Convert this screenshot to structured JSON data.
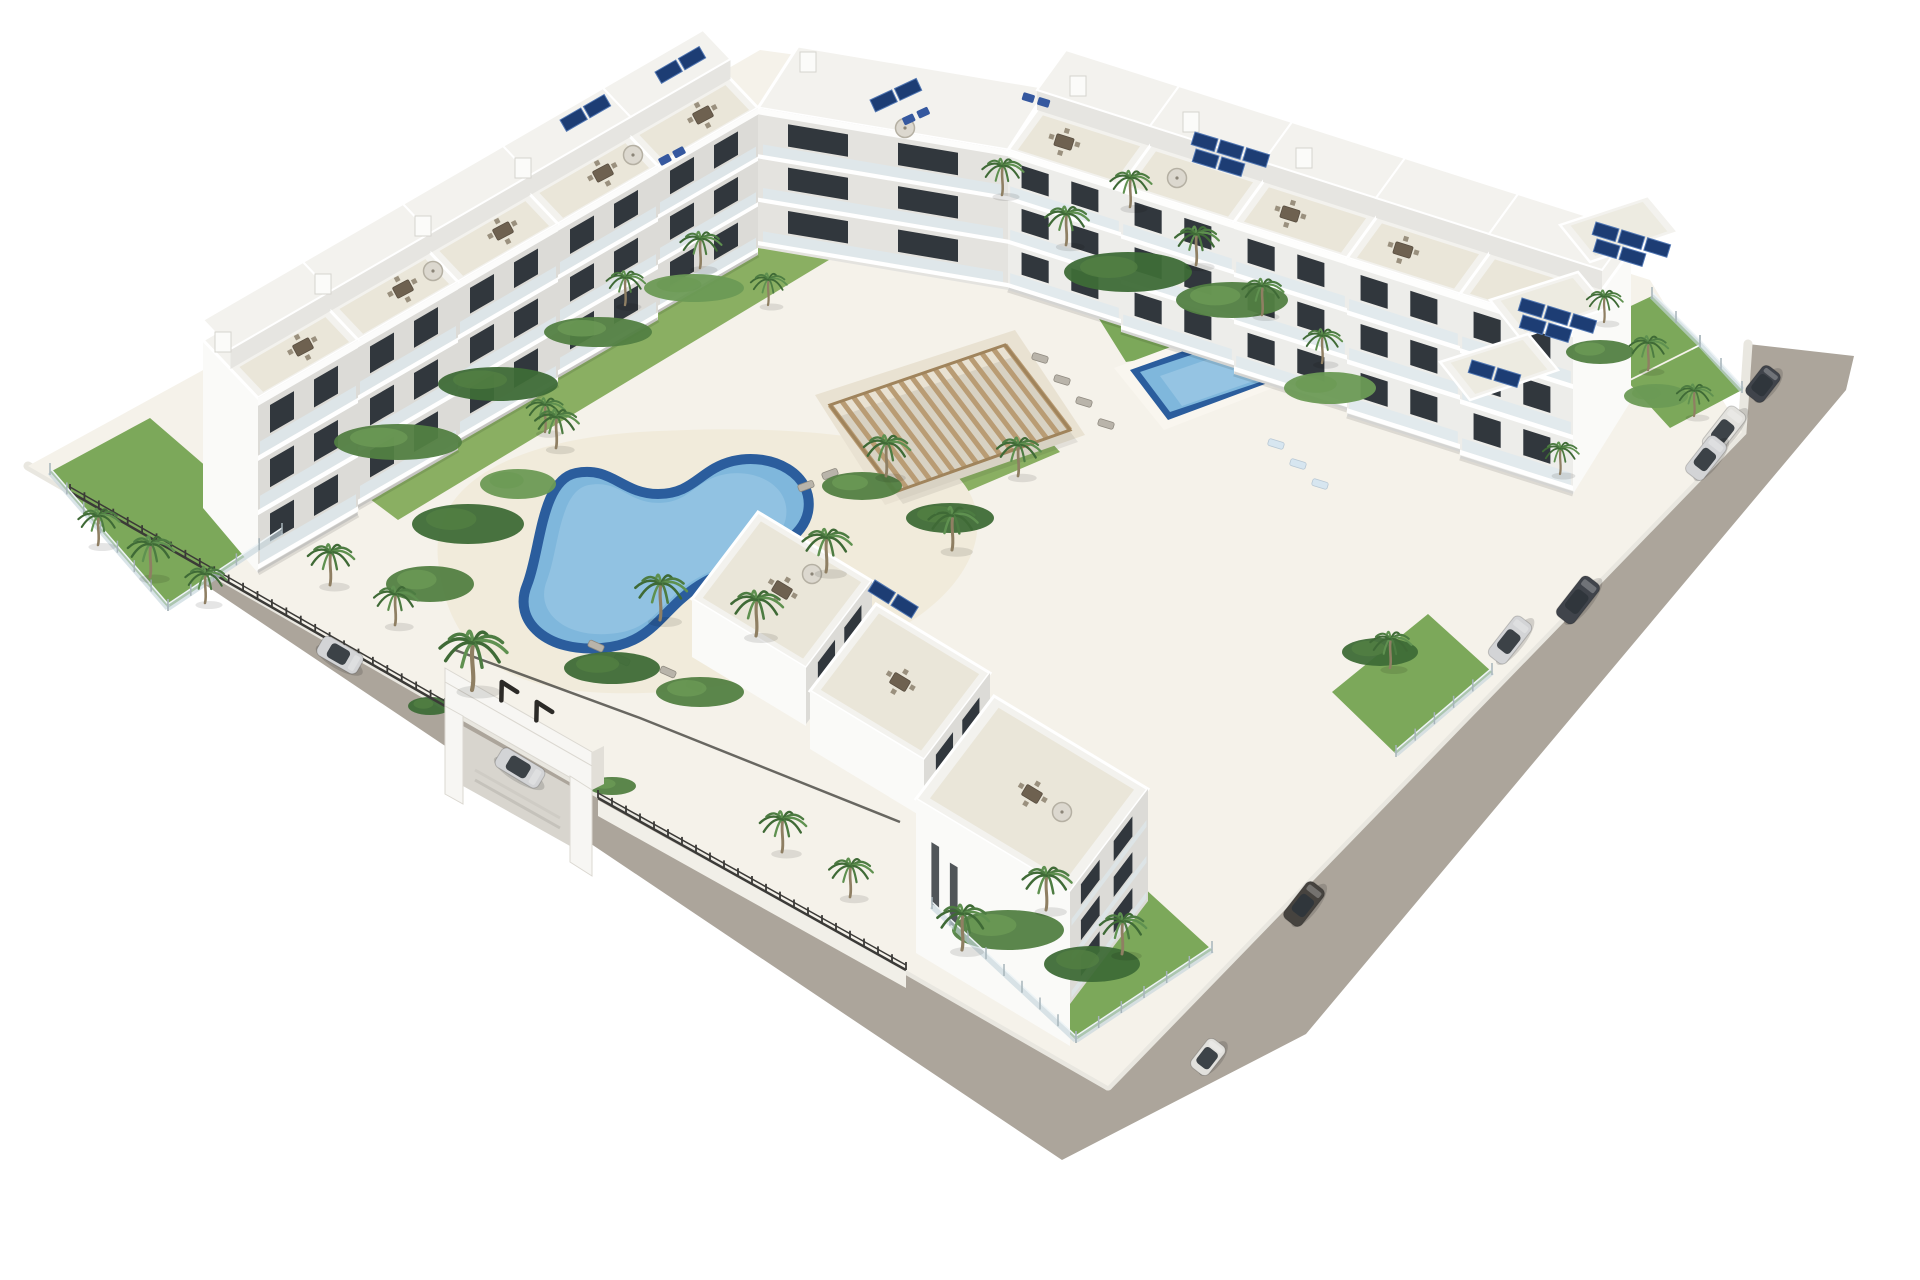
{
  "meta": {
    "type": "architectural_3d_render",
    "subject": "Aerial 3D render of a white modern apartment complex with central kidney-shaped pool, second rectangular pool, wooden pergola, palm trees, roof terraces with furniture, rooftop solar panels, glass-fenced gardens, entrance gate and perimeter road with parked cars",
    "background": "#ffffff"
  },
  "palette": {
    "background": "#ffffff",
    "road": "#aca59b",
    "curb": "#e9e7e0",
    "site": "#f5f2ea",
    "deck": "#f1ebdb",
    "paving": "#e9e2d2",
    "lawn": "#8aaf62",
    "grass": "#7ca85a",
    "shrubDark": "#3e6b37",
    "shrubMid": "#527f42",
    "shrubLight": "#6b9a55",
    "facadeShade": "#dcdbd7",
    "facadeLight": "#ededea",
    "gable": "#fafaf8",
    "roof": "#f3f2ee",
    "terrace": "#eae6d9",
    "stepFace": "#e6e5e1",
    "window": "#31373d",
    "rail": "#dde8ed",
    "slab": "#ffffff",
    "poolRim": "#2b5d9d",
    "water": "#7fb7dc",
    "waterLight": "#a3cde8",
    "pergolaSlat": "#b99c74",
    "pergolaFrame": "#a0845c",
    "fenceDark": "#3b3a37",
    "glass": "#c6d6dd",
    "glassPost": "#a7b4ba",
    "wall": "#f1efe8",
    "wallShade": "#d9d6ce",
    "solar": "#1d3d74",
    "solarLine": "#5076b2",
    "trunk": "#8f7f63",
    "frondDark": "#3f6a36",
    "frondMid": "#4d7c42",
    "frondLight": "#5f9150",
    "furniture": "#6e6150",
    "furnitureLight": "#9a907e",
    "umbrella": "#dcd8cf",
    "loungerGray": "#b9b4aa",
    "loungerBlue": "#35589f",
    "loungerPale": "#d7e6f0",
    "carSilver": "#d3d4d6",
    "carWhite": "#e2e1dd",
    "carDark": "#46433f",
    "carCharcoal": "#40444b",
    "cabin": "#2f353b",
    "shadow": "rgba(0,0,0,0.14)"
  },
  "buildings": {
    "rows": [
      {
        "id": "nw-row",
        "n": 5,
        "bx": 258,
        "by": 398,
        "sx": 100,
        "sy": -58,
        "h0": 175,
        "dh": -7,
        "dx": -55,
        "dy": -58,
        "facade": "facadeShade",
        "gableAt": "start",
        "order": "reverse"
      },
      {
        "id": "ne-row",
        "n": 5,
        "bx": 1008,
        "by": 150,
        "sx": 113,
        "sy": 36,
        "h0": 140,
        "dh": 6,
        "dx": 58,
        "dy": -80,
        "facade": "facadeLight",
        "gableAt": "end",
        "order": "forward"
      }
    ],
    "connector": {
      "facade": [
        [
          758,
          108
        ],
        [
          1008,
          150
        ],
        [
          1008,
          290
        ],
        [
          758,
          248
        ]
      ],
      "roof": [
        [
          758,
          108
        ],
        [
          1008,
          150
        ],
        [
          1048,
          88
        ],
        [
          798,
          46
        ]
      ]
    },
    "annexRoofs": [
      [
        [
          1560,
          225
        ],
        [
          1648,
          196
        ],
        [
          1678,
          232
        ],
        [
          1590,
          262
        ]
      ],
      [
        [
          1490,
          300
        ],
        [
          1578,
          272
        ],
        [
          1608,
          308
        ],
        [
          1520,
          338
        ]
      ],
      [
        [
          1440,
          362
        ],
        [
          1528,
          334
        ],
        [
          1558,
          370
        ],
        [
          1470,
          400
        ]
      ]
    ],
    "seCluster": [
      {
        "roof": [
          [
            758,
            512
          ],
          [
            872,
            581
          ],
          [
            806,
            668
          ],
          [
            692,
            599
          ]
        ],
        "sw": [
          [
            692,
            599
          ],
          [
            806,
            668
          ],
          [
            806,
            726
          ],
          [
            692,
            657
          ]
        ],
        "se": [
          [
            806,
            668
          ],
          [
            872,
            581
          ],
          [
            872,
            637
          ],
          [
            806,
            724
          ]
        ],
        "tall": false
      },
      {
        "roof": [
          [
            876,
            604
          ],
          [
            990,
            673
          ],
          [
            924,
            760
          ],
          [
            810,
            691
          ]
        ],
        "sw": [
          [
            810,
            691
          ],
          [
            924,
            760
          ],
          [
            924,
            818
          ],
          [
            810,
            749
          ]
        ],
        "se": [
          [
            924,
            760
          ],
          [
            990,
            673
          ],
          [
            990,
            731
          ],
          [
            924,
            818
          ]
        ],
        "tall": false
      },
      {
        "roof": [
          [
            994,
            696
          ],
          [
            1148,
            789
          ],
          [
            1070,
            892
          ],
          [
            916,
            799
          ]
        ],
        "sw": [
          [
            916,
            799
          ],
          [
            1070,
            892
          ],
          [
            1070,
            1046
          ],
          [
            916,
            953
          ]
        ],
        "se": [
          [
            1070,
            892
          ],
          [
            1148,
            789
          ],
          [
            1148,
            901
          ],
          [
            1070,
            1004
          ]
        ],
        "tall": true
      }
    ],
    "bulkheads": [
      [
        215,
        332
      ],
      [
        315,
        274
      ],
      [
        415,
        216
      ],
      [
        515,
        158
      ],
      [
        1070,
        76
      ],
      [
        1183,
        112
      ],
      [
        1296,
        148
      ],
      [
        800,
        52
      ]
    ]
  },
  "solarArrays": [
    [
      560,
      120,
      -30,
      2
    ],
    [
      655,
      72,
      -30,
      2
    ],
    [
      870,
      100,
      -25,
      2
    ],
    [
      1195,
      132,
      17,
      3
    ],
    [
      1596,
      222,
      17,
      3
    ],
    [
      1522,
      298,
      17,
      3
    ],
    [
      1472,
      360,
      17,
      2
    ],
    [
      875,
      580,
      32,
      2
    ]
  ],
  "roofFurniture": {
    "tables": [
      [
        303,
        347,
        -28
      ],
      [
        403,
        289,
        -28
      ],
      [
        503,
        231,
        -28
      ],
      [
        603,
        173,
        -28
      ],
      [
        703,
        115,
        -28
      ],
      [
        1064,
        142,
        17
      ],
      [
        1290,
        214,
        17
      ],
      [
        1403,
        250,
        17
      ],
      [
        782,
        590,
        31
      ],
      [
        900,
        682,
        31
      ],
      [
        1032,
        794,
        31
      ]
    ],
    "umbrellas": [
      [
        433,
        271
      ],
      [
        633,
        155
      ],
      [
        1177,
        178
      ],
      [
        812,
        574
      ],
      [
        1062,
        812
      ],
      [
        905,
        128
      ]
    ],
    "blueLoungers": [
      [
        672,
        156,
        -28
      ],
      [
        916,
        116,
        -25
      ],
      [
        1036,
        100,
        17
      ]
    ]
  },
  "courtyard": {
    "grayLoungers": [
      [
        1040,
        358,
        17
      ],
      [
        1062,
        380,
        17
      ],
      [
        1084,
        402,
        17
      ],
      [
        1106,
        424,
        17
      ],
      [
        596,
        646,
        24
      ],
      [
        622,
        660,
        24
      ],
      [
        668,
        672,
        24
      ],
      [
        694,
        686,
        24
      ],
      [
        806,
        486,
        -20
      ],
      [
        830,
        474,
        -20
      ]
    ],
    "paleLoungers": [
      [
        1276,
        444,
        17
      ],
      [
        1298,
        464,
        17
      ],
      [
        1320,
        484,
        17
      ]
    ]
  },
  "pergola": {
    "corners": [
      [
        830,
        405
      ],
      [
        1005,
        345
      ],
      [
        1070,
        430
      ],
      [
        895,
        492
      ]
    ],
    "slats": 16
  },
  "gardens": [
    {
      "pts": [
        [
          50,
          472
        ],
        [
          150,
          418
        ],
        [
          282,
          532
        ],
        [
          168,
          608
        ]
      ],
      "tone": "grass"
    },
    {
      "pts": [
        [
          342,
          478
        ],
        [
          862,
          168
        ],
        [
          920,
          205
        ],
        [
          398,
          520
        ]
      ],
      "tone": "lawn"
    },
    {
      "pts": [
        [
          1076,
          282
        ],
        [
          1272,
          248
        ],
        [
          1320,
          330
        ],
        [
          1126,
          362
        ]
      ],
      "tone": "grass"
    },
    {
      "pts": [
        [
          932,
          906
        ],
        [
          1072,
          822
        ],
        [
          1212,
          950
        ],
        [
          1076,
          1040
        ]
      ],
      "tone": "grass"
    },
    {
      "pts": [
        [
          1580,
          330
        ],
        [
          1652,
          296
        ],
        [
          1700,
          344
        ],
        [
          1628,
          380
        ]
      ],
      "tone": "grass"
    },
    {
      "pts": [
        [
          1628,
          382
        ],
        [
          1700,
          346
        ],
        [
          1742,
          390
        ],
        [
          1670,
          428
        ]
      ],
      "tone": "grass"
    },
    {
      "pts": [
        [
          1332,
          692
        ],
        [
          1428,
          614
        ],
        [
          1492,
          672
        ],
        [
          1396,
          754
        ]
      ],
      "tone": "grass"
    },
    {
      "pts": [
        [
          900,
          432
        ],
        [
          1006,
          392
        ],
        [
          1060,
          452
        ],
        [
          952,
          498
        ]
      ],
      "tone": "lawn"
    }
  ],
  "shrubs": [
    [
      468,
      524,
      56,
      20,
      1
    ],
    [
      430,
      584,
      44,
      18,
      2
    ],
    [
      518,
      484,
      38,
      15,
      3
    ],
    [
      398,
      442,
      64,
      18,
      2
    ],
    [
      498,
      384,
      60,
      17,
      1
    ],
    [
      598,
      332,
      54,
      15,
      2
    ],
    [
      694,
      288,
      50,
      14,
      3
    ],
    [
      862,
      486,
      40,
      14,
      2
    ],
    [
      950,
      518,
      44,
      15,
      1
    ],
    [
      1128,
      272,
      64,
      20,
      1
    ],
    [
      1232,
      300,
      56,
      18,
      2
    ],
    [
      1330,
      388,
      46,
      16,
      3
    ],
    [
      612,
      668,
      48,
      16,
      1
    ],
    [
      700,
      692,
      44,
      15,
      2
    ],
    [
      1008,
      930,
      56,
      20,
      2
    ],
    [
      1092,
      964,
      48,
      18,
      1
    ],
    [
      1600,
      352,
      34,
      12,
      2
    ],
    [
      1656,
      396,
      32,
      12,
      3
    ],
    [
      430,
      706,
      22,
      9,
      1
    ],
    [
      612,
      786,
      24,
      9,
      2
    ],
    [
      1380,
      652,
      38,
      14,
      1
    ]
  ],
  "palms": [
    [
      98,
      545,
      0.8
    ],
    [
      150,
      577,
      0.9
    ],
    [
      205,
      603,
      0.8
    ],
    [
      330,
      585,
      0.9
    ],
    [
      395,
      625,
      0.85
    ],
    [
      472,
      690,
      1.3
    ],
    [
      556,
      448,
      0.85
    ],
    [
      660,
      620,
      1.0
    ],
    [
      756,
      636,
      1.0
    ],
    [
      826,
      572,
      0.95
    ],
    [
      886,
      476,
      0.9
    ],
    [
      952,
      550,
      0.95
    ],
    [
      1018,
      476,
      0.85
    ],
    [
      545,
      432,
      0.75
    ],
    [
      625,
      305,
      0.75
    ],
    [
      700,
      268,
      0.8
    ],
    [
      768,
      305,
      0.7
    ],
    [
      1002,
      195,
      0.8
    ],
    [
      1066,
      245,
      0.85
    ],
    [
      1130,
      207,
      0.8
    ],
    [
      1196,
      265,
      0.85
    ],
    [
      1262,
      315,
      0.8
    ],
    [
      1322,
      363,
      0.75
    ],
    [
      1604,
      322,
      0.7
    ],
    [
      1648,
      370,
      0.75
    ],
    [
      1694,
      416,
      0.7
    ],
    [
      962,
      950,
      1.0
    ],
    [
      1046,
      910,
      0.95
    ],
    [
      1122,
      954,
      0.9
    ],
    [
      1390,
      668,
      0.8
    ],
    [
      1560,
      474,
      0.7
    ],
    [
      782,
      852,
      0.9
    ],
    [
      850,
      897,
      0.85
    ]
  ],
  "cars": [
    {
      "x": 340,
      "y": 655,
      "rot": 30,
      "type": "suv",
      "color": "carSilver",
      "name": "silver-suv"
    },
    {
      "x": 520,
      "y": 768,
      "rot": 31,
      "type": "sedan",
      "color": "carSilver",
      "name": "silver-sedan"
    },
    {
      "x": 1304,
      "y": 904,
      "rot": -52,
      "type": "suv",
      "color": "carDark",
      "name": "dark-suv"
    },
    {
      "x": 1208,
      "y": 1057,
      "rot": -52,
      "type": "city",
      "color": "carWhite",
      "name": "white-city-car"
    },
    {
      "x": 1763,
      "y": 384,
      "rot": -52,
      "type": "city",
      "color": "carCharcoal",
      "name": "gray-hatchback"
    },
    {
      "x": 1724,
      "y": 430,
      "rot": -52,
      "type": "sedan",
      "color": "carWhite",
      "name": "white-sedan"
    },
    {
      "x": 1706,
      "y": 458,
      "rot": -52,
      "type": "suv",
      "color": "carSilver",
      "name": "silver-suv-2"
    },
    {
      "x": 1578,
      "y": 600,
      "rot": -52,
      "type": "sedan",
      "color": "carCharcoal",
      "name": "charcoal-sedan"
    },
    {
      "x": 1510,
      "y": 640,
      "rot": -52,
      "type": "sedan",
      "color": "carSilver",
      "name": "silver-sedan-2"
    }
  ],
  "fences": {
    "dark": [
      [
        [
          70,
          492
        ],
        [
          445,
          706
        ]
      ],
      [
        [
          598,
          798
        ],
        [
          906,
          970
        ]
      ]
    ],
    "glass": [
      [
        [
          50,
          472
        ],
        [
          168,
          608
        ],
        [
          282,
          532
        ]
      ],
      [
        [
          932,
          906
        ],
        [
          1076,
          1040
        ],
        [
          1212,
          950
        ]
      ],
      [
        [
          1652,
          296
        ],
        [
          1700,
          344
        ],
        [
          1742,
          390
        ]
      ],
      [
        [
          1396,
          754
        ],
        [
          1492,
          672
        ]
      ]
    ],
    "wall": [
      [
        598,
        800
      ],
      [
        906,
        972
      ],
      [
        906,
        988
      ],
      [
        598,
        816
      ]
    ]
  },
  "counts": {
    "apartment_modules": 13,
    "palm_trees": 33,
    "parked_cars": 9,
    "pools": 2,
    "solar_arrays": 8
  }
}
